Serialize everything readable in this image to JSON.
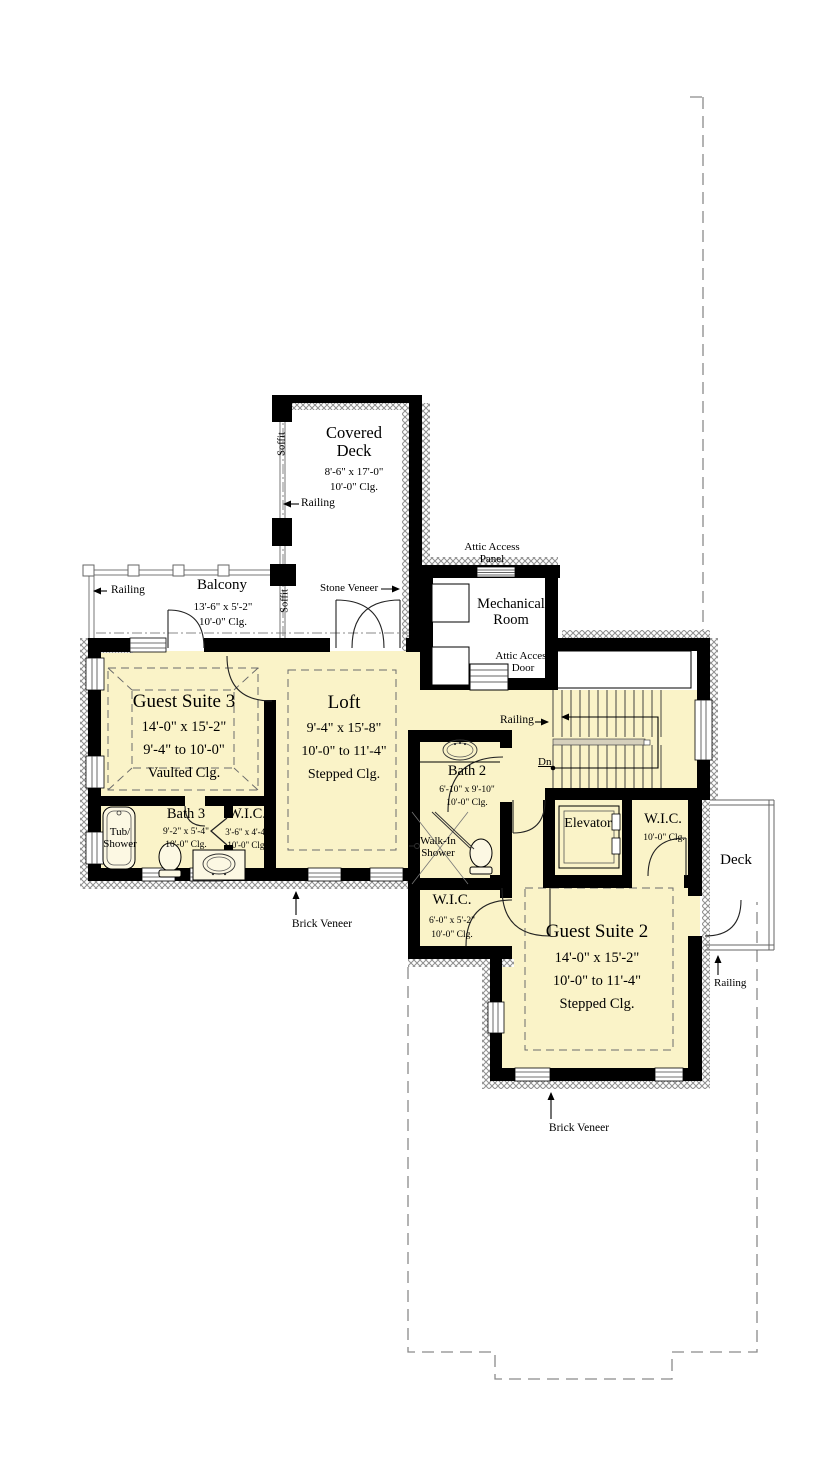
{
  "rooms": {
    "covered_deck": {
      "name": "Covered\nDeck",
      "dims": "8'-6\" x 17'-0\"",
      "ceiling": "10'-0\" Clg."
    },
    "balcony": {
      "name": "Balcony",
      "dims": "13'-6\" x 5'-2\"",
      "ceiling": "10'-0\" Clg."
    },
    "mechanical_room": {
      "name": "Mechanical\nRoom"
    },
    "guest_suite_3": {
      "name": "Guest Suite 3",
      "dims": "14'-0\" x 15'-2\"",
      "height_range": "9'-4\" to 10'-0\"",
      "ceiling": "Vaulted Clg."
    },
    "loft": {
      "name": "Loft",
      "dims": "9'-4\" x 15'-8\"",
      "height_range": "10'-0\" to 11'-4\"",
      "ceiling": "Stepped Clg."
    },
    "bath_2": {
      "name": "Bath 2",
      "dims": "6'-10\" x 9'-10\"",
      "ceiling": "10'-0\" Clg."
    },
    "bath_3": {
      "name": "Bath 3",
      "dims": "9'-2\" x 5'-4\"",
      "ceiling": "10'-0\" Clg."
    },
    "wic_bath_3": {
      "name": "W.I.C.",
      "dims": "3'-6\" x 4'-4\"",
      "ceiling": "10'-0\" Clg."
    },
    "wic_hall": {
      "name": "W.I.C.",
      "dims": "6'-0\" x 5'-2\"",
      "ceiling": "10'-0\" Clg."
    },
    "wic_guest_2": {
      "name": "W.I.C.",
      "ceiling": "10'-0\" Clg."
    },
    "elevator": {
      "name": "Elevator"
    },
    "deck": {
      "name": "Deck"
    },
    "guest_suite_2": {
      "name": "Guest Suite 2",
      "dims": "14'-0\" x 15'-2\"",
      "height_range": "10'-0\" to 11'-4\"",
      "ceiling": "Stepped Clg."
    }
  },
  "fixtures": {
    "tub_shower": "Tub/\nShower",
    "walk_in_shower": "Walk-In\nShower"
  },
  "annotations": {
    "railing": "Railing",
    "soffit": "Soffit",
    "stone_veneer": "Stone Veneer",
    "brick_veneer": "Brick Veneer",
    "attic_access_panel": "Attic Access\nPanel",
    "attic_access_door": "Attic Access\nDoor",
    "down": "Dn"
  },
  "colors": {
    "floor": "#FAF3C8",
    "wall": "#000000",
    "hatch": "#8F8F8F",
    "dashed_outline": "#8A8A8A",
    "stair_rail_band": "#D6D0BC"
  }
}
